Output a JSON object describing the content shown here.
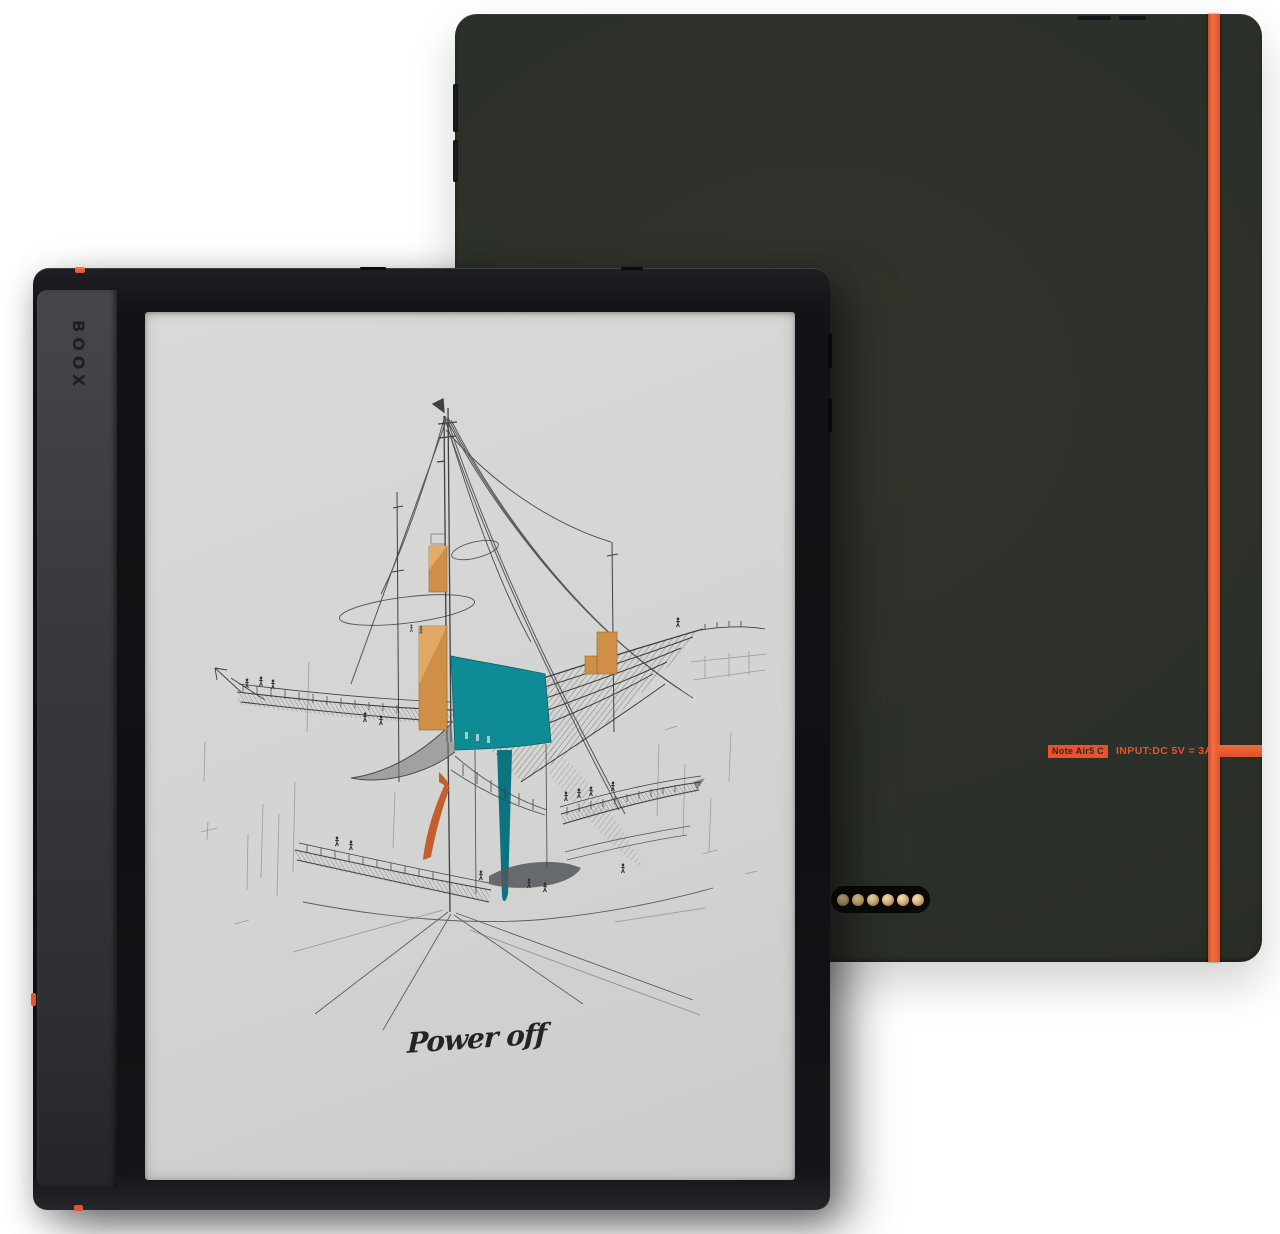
{
  "scene": {
    "type": "product-photo",
    "product": "E-ink tablet shown from front and back",
    "background_color": "#ffffff"
  },
  "front": {
    "logo_text": "BOOX",
    "screen_art": "architectural concept sketch with teal and ochre accents",
    "handwriting": "Power off"
  },
  "back": {
    "model_badge": "Note Air5 C",
    "input_rating": "INPUT:DC 5V = 3A",
    "pogo_pins": 6
  },
  "colors": {
    "accent_orange": "#e8532e",
    "back_body": "#2c302a",
    "front_bezel": "#121316",
    "spine_gray": "#393a3e",
    "screen_paper": "#d5d5d3",
    "sketch_ink": "#3f4042",
    "sketch_teal": "#0f8b95",
    "sketch_teal_dark": "#0b7480",
    "sketch_ochre": "#cf8f47",
    "sketch_ochre_light": "#e2ab66",
    "sketch_burnt_orange": "#c2602b",
    "pin_gold": "#dcbd83"
  }
}
